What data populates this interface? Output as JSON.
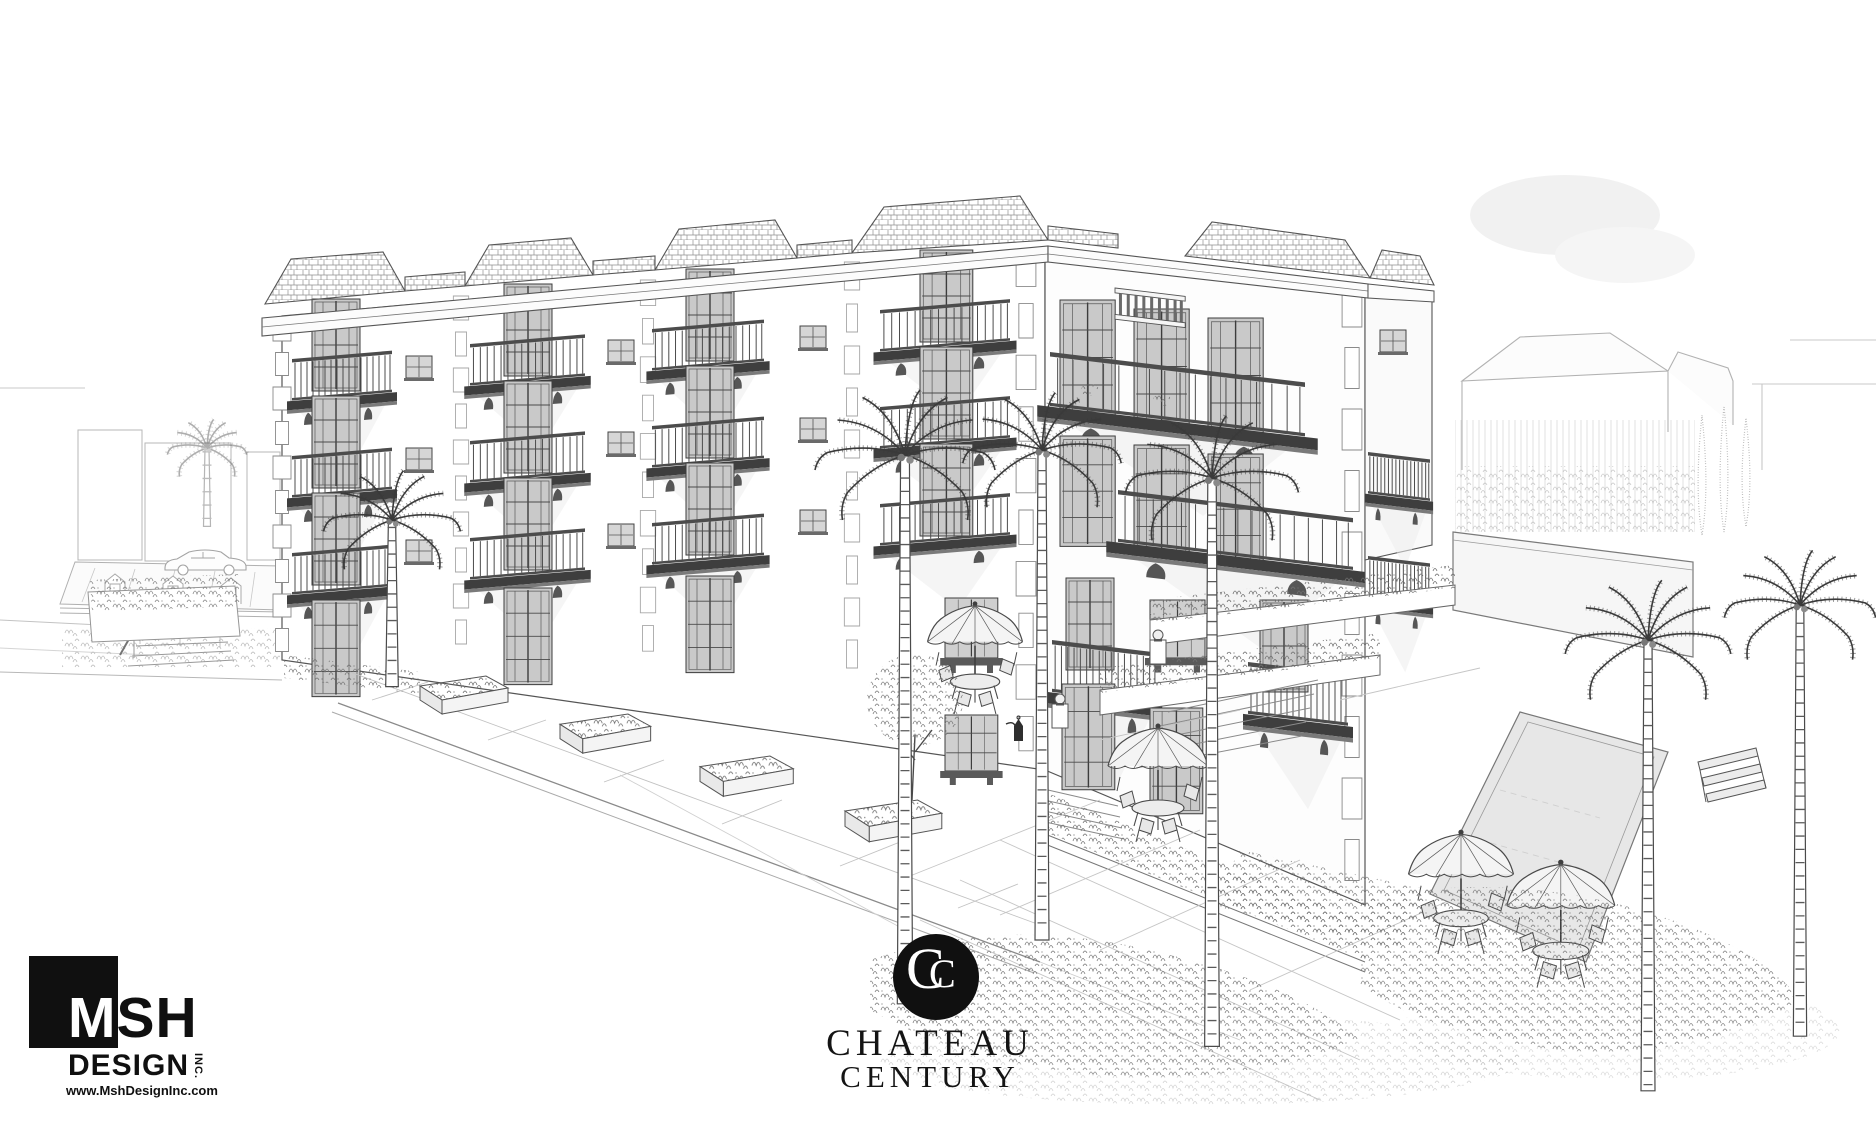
{
  "palette": {
    "paper_white": "#ffffff",
    "pencil_dark": "#3d3d3d",
    "pencil_mid": "#6e6e6e",
    "pencil_faint": "#a5a5a5",
    "logo_ink": "#101010"
  },
  "designer_logo": {
    "msh_m": "M",
    "msh_sh": "SH",
    "design": "DESIGN",
    "inc": "INC.",
    "website": "www.MshDesignInc.com"
  },
  "project_logo": {
    "monogram_outer": "C",
    "monogram_inner": "C",
    "name_line1": "CHATEAU",
    "name_line2": "CENTURY"
  }
}
